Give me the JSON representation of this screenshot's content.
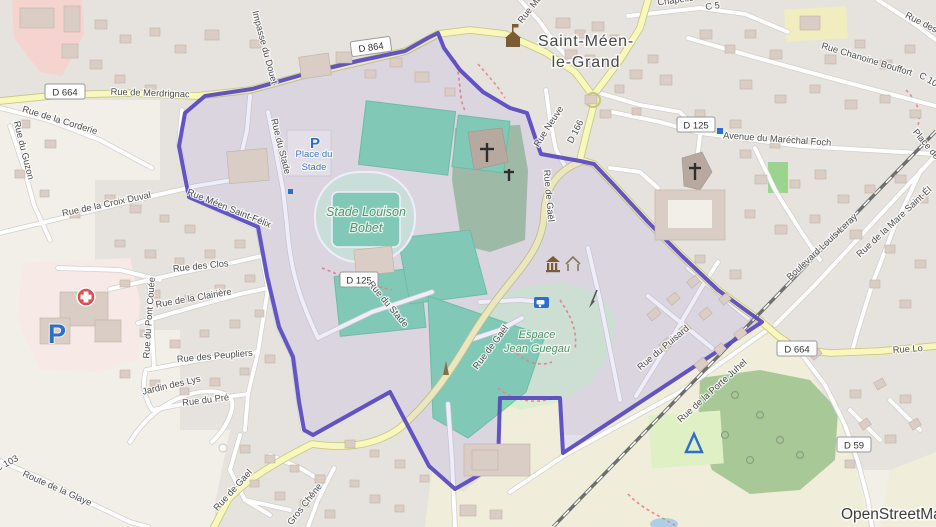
{
  "attribution": "OpenStreetMap",
  "places": {
    "town1": "Saint-Méen-",
    "town2": "le-Grand",
    "place_stade1": "Place du",
    "place_stade2": "Stade",
    "stade1": "Stade Louison",
    "stade2": "Bobet",
    "espace1": "Espace",
    "espace2": "Jean Guegau"
  },
  "badges": {
    "d664_w": "D 664",
    "d864": "D 864",
    "d125_ne": "D 125",
    "d125_c": "D 125",
    "d664_se": "D 664",
    "d59": "D 59"
  },
  "streets": {
    "merdrignac": "Rue de Merdrignac",
    "corderie": "Rue de la Corderie",
    "guzon": "Rue du Guzon",
    "impasse_douet": "Impasse du Douet",
    "stade_n": "Rue du Stade",
    "stade_s": "Rue du Stade",
    "meen_saint_felix": "Rue Méen Saint-Félix",
    "croix_duval": "Rue de la Croix Duval",
    "clos": "Rue des Clos",
    "clairiere": "Rue de la Clairière",
    "pont_couee": "Rue du Pont Couée",
    "peupliers": "Rue des Peupliers",
    "pre": "Rue du Pré",
    "glaye": "Route de la Glaye",
    "c103": "C 103",
    "jardin_lys": "Jardin des Lys",
    "gael_sw": "Rue de Gael",
    "gros_chene": "Gros Chêne",
    "gael_v": "Rue de Gaël",
    "gael_d": "Rue de Gaël",
    "neuve": "Rue Neuve",
    "d166": "D 166",
    "rue_ma": "Rue Ma",
    "chapelle": "Chapelle",
    "c5": "C 5",
    "rue_des": "Rue des",
    "chanoine": "Rue Chanoine Bouffort",
    "c10": "C 10",
    "foch": "Avenue du Maréchal Foch",
    "place_de": "Place de",
    "leray": "Boulevard Louis Leray",
    "mare": "Rue de la Mare Saint-Él",
    "puisard": "Rue du Puisard",
    "porte_juhel": "Rue de la Porte Juhel",
    "rue_lo": "Rue Lo"
  },
  "icons": {
    "parking_glyph": "P"
  },
  "colors": {
    "boundary": "#5443c2",
    "road_major_fill": "#f8f8bc",
    "pitch": "#82d6b2",
    "park": "#d8efd2",
    "forest": "#a9c897",
    "residential": "#e6e3df",
    "retail_pink": "#f5d3ce",
    "water": "#aacfe6"
  }
}
